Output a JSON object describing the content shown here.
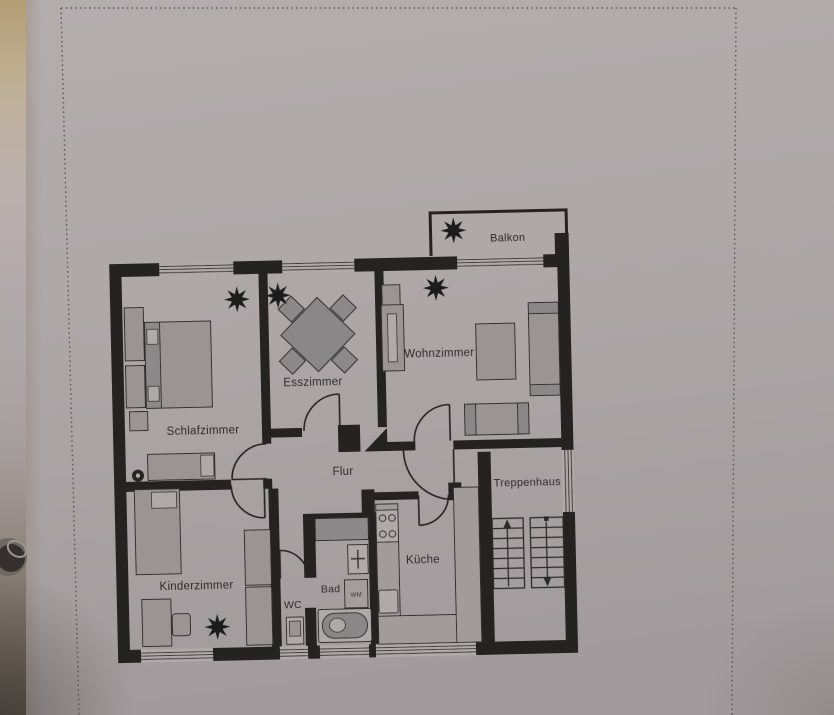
{
  "photo": {
    "description": "photographed paper floor plan",
    "paper_color": "#aca5a6",
    "ink_color": "#262222",
    "furniture_color": "#9a9495",
    "edge_color": "#b19d75"
  },
  "floorplan": {
    "rooms": [
      {
        "id": "balkon",
        "label": "Balkon"
      },
      {
        "id": "schlafzimmer",
        "label": "Schlafzimmer"
      },
      {
        "id": "esszimmer",
        "label": "Esszimmer"
      },
      {
        "id": "wohnzimmer",
        "label": "Wohnzimmer"
      },
      {
        "id": "flur",
        "label": "Flur"
      },
      {
        "id": "treppenhaus",
        "label": "Treppenhaus"
      },
      {
        "id": "kinderzimmer",
        "label": "Kinderzimmer"
      },
      {
        "id": "wc",
        "label": "WC"
      },
      {
        "id": "bad",
        "label": "Bad"
      },
      {
        "id": "kueche",
        "label": "Küche"
      }
    ],
    "appliances": [
      {
        "id": "wm",
        "label": "WM"
      }
    ]
  }
}
